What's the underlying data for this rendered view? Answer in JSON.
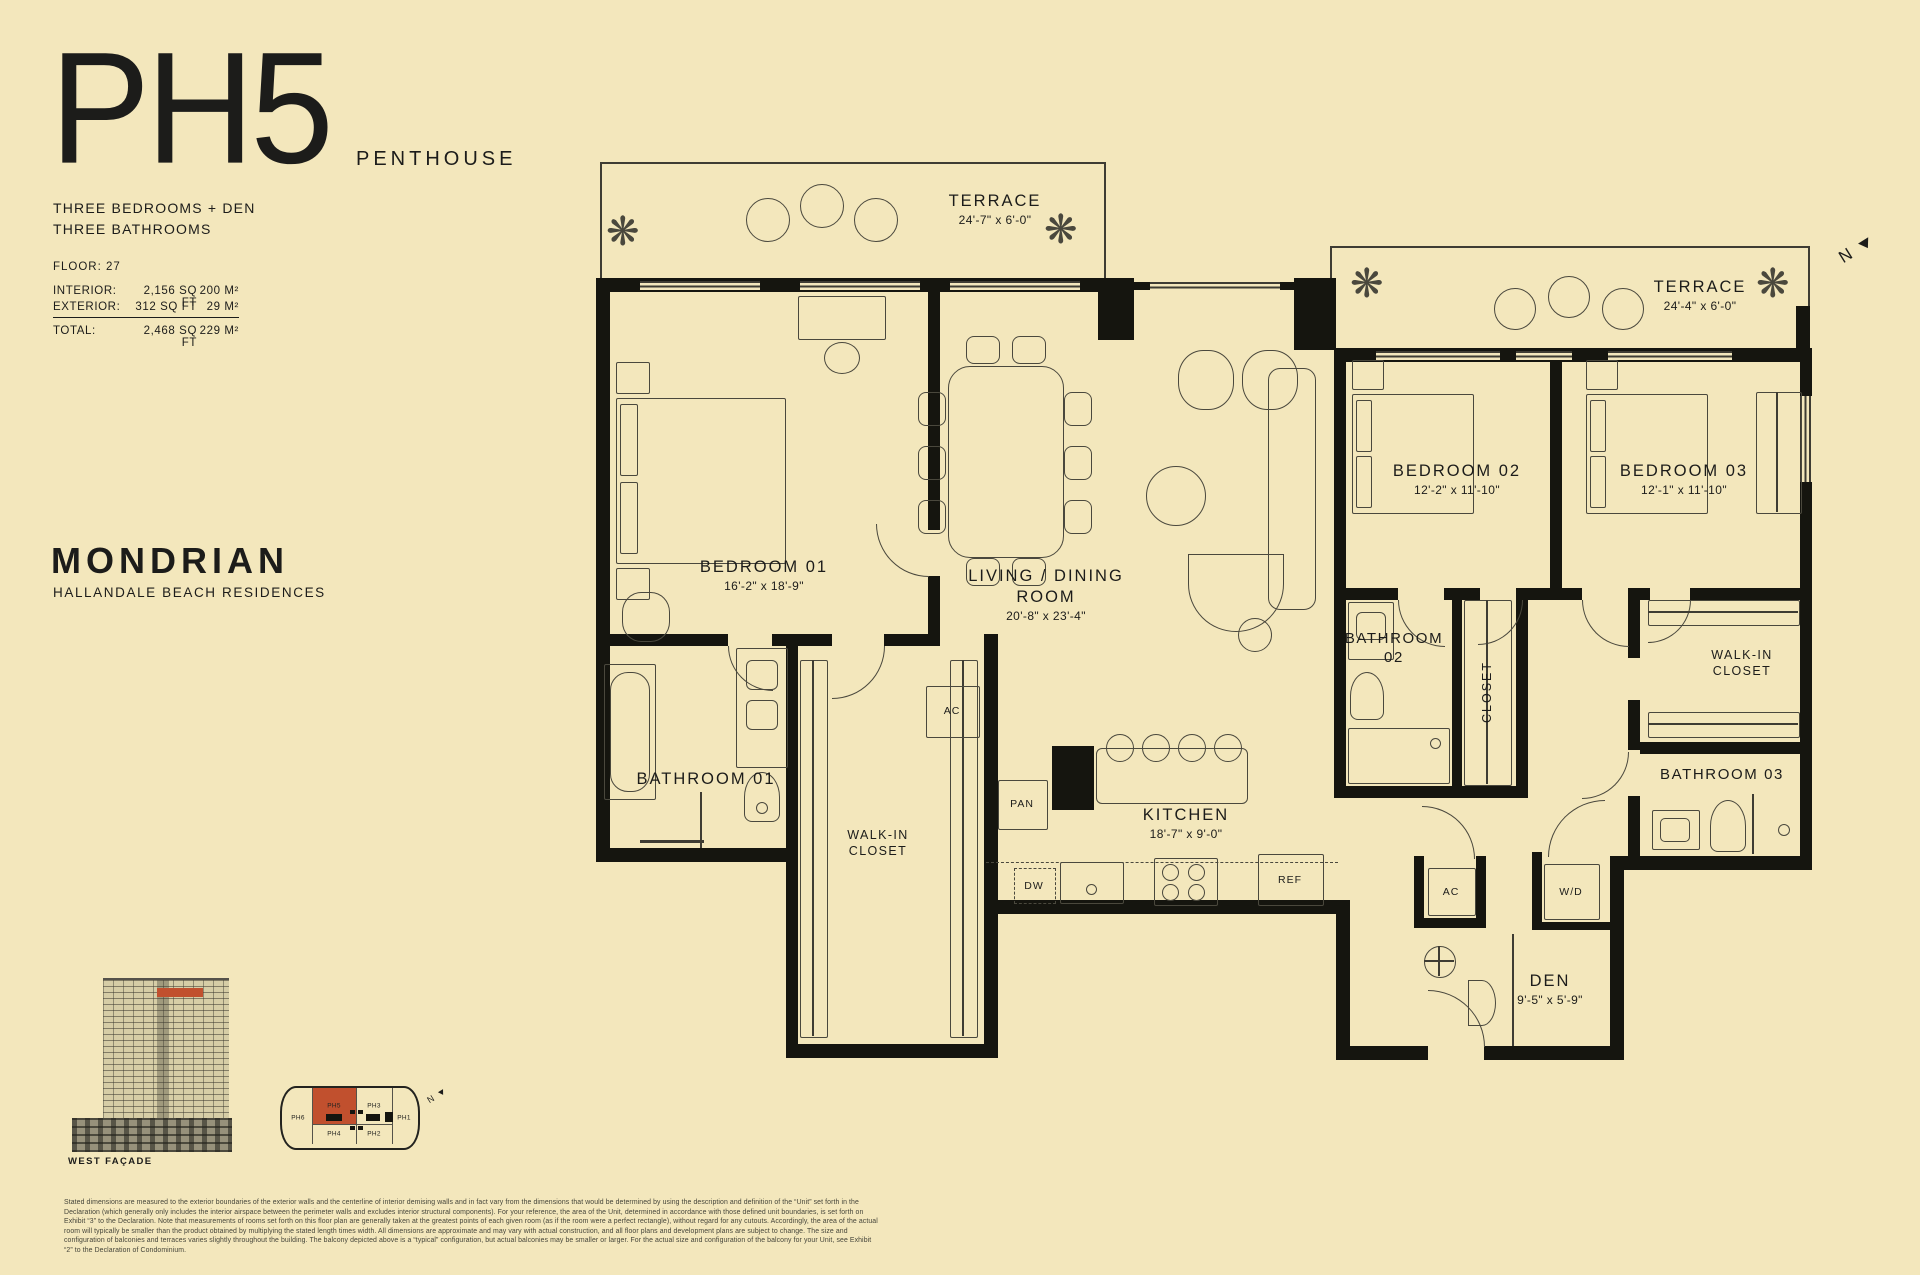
{
  "colors": {
    "background": "#F3E7BC",
    "ink": "#1C1C1A",
    "accent": "#C1502E"
  },
  "header": {
    "unit": "PH5",
    "unit_type": "PENTHOUSE",
    "config_line1": "THREE BEDROOMS + DEN",
    "config_line2": "THREE BATHROOMS",
    "floor": "FLOOR: 27",
    "area_rows": [
      {
        "label": "INTERIOR:",
        "sqft": "2,156 SQ FT",
        "metric": "200 M²"
      },
      {
        "label": "EXTERIOR:",
        "sqft": "312 SQ FT",
        "metric": "29 M²"
      }
    ],
    "total_row": {
      "label": "TOTAL:",
      "sqft": "2,468 SQ FT",
      "metric": "229 M²"
    }
  },
  "brand": {
    "name": "MONDRIAN",
    "tagline": "HALLANDALE BEACH RESIDENCES"
  },
  "plan": {
    "north": "N",
    "rooms": {
      "terrace1": {
        "name": "TERRACE",
        "dims": "24'-7\" x 6'-0\""
      },
      "terrace2": {
        "name": "TERRACE",
        "dims": "24'-4\" x 6'-0\""
      },
      "bedroom1": {
        "name": "BEDROOM 01",
        "dims": "16'-2\" x 18'-9\""
      },
      "living": {
        "name": "LIVING / DINING ROOM",
        "dims": "20'-8\" x 23'-4\""
      },
      "bedroom2": {
        "name": "BEDROOM 02",
        "dims": "12'-2\" x 11'-10\""
      },
      "bedroom3": {
        "name": "BEDROOM 03",
        "dims": "12'-1\" x 11'-10\""
      },
      "bathroom1": {
        "name": "BATHROOM 01"
      },
      "bathroom2": {
        "name": "BATHROOM 02"
      },
      "bathroom3": {
        "name": "BATHROOM 03"
      },
      "closet": {
        "name": "CLOSET"
      },
      "walkin_left": {
        "name": "WALK-IN CLOSET"
      },
      "walkin_right": {
        "name": "WALK-IN CLOSET"
      },
      "kitchen": {
        "name": "KITCHEN",
        "dims": "18'-7\" x 9'-0\""
      },
      "den": {
        "name": "DEN",
        "dims": "9'-5\" x 5'-9\""
      }
    },
    "fixtures": {
      "ac": "AC",
      "pan": "PAN",
      "dw": "DW",
      "ref": "REF",
      "wd": "W/D"
    }
  },
  "keyplan": {
    "highlight_unit": "PH5",
    "units": [
      {
        "id": "PH6"
      },
      {
        "id": "PH5"
      },
      {
        "id": "PH3"
      },
      {
        "id": "PH1"
      },
      {
        "id": "PH4"
      },
      {
        "id": "PH2"
      }
    ],
    "north": "N",
    "facade_caption": "WEST FAÇADE"
  },
  "footer": {
    "disclaimer": "Stated dimensions are measured to the exterior boundaries of the exterior walls and the centerline of interior demising walls and in fact vary from the dimensions that would be determined by using the description and definition of the “Unit” set forth in the Declaration (which generally only includes the interior airspace between the perimeter walls and excludes interior structural components). For your reference, the area of the Unit, determined in accordance with those defined unit boundaries, is set forth on Exhibit “3” to the Declaration. Note that measurements of rooms set forth on this floor plan are generally taken at the greatest points of each given room (as if the room were a perfect rectangle), without regard for any cutouts. Accordingly, the area of the actual room will typically be smaller than the product obtained by multiplying the stated length times width. All dimensions are approximate and may vary with actual construction, and all floor plans and development plans are subject to change. The size and configuration of balconies and terraces varies slightly throughout the building. The balcony depicted above is a “typical” configuration, but actual balconies may be smaller or larger. For the actual size and configuration of the balcony for your Unit, see Exhibit “2” to the Declaration of Condominium."
  }
}
